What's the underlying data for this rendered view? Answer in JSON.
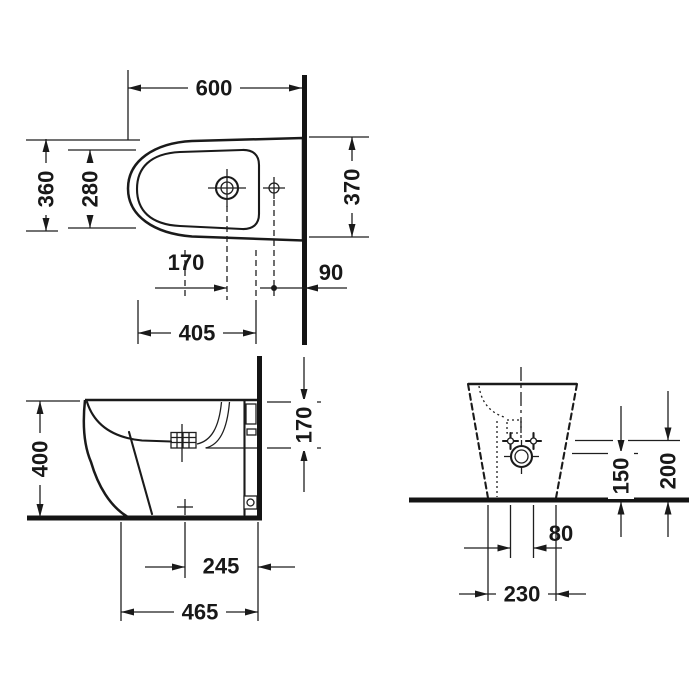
{
  "drawing": {
    "type": "bidet-installation-technical-drawing",
    "colors": {
      "line": "#1a1a1a",
      "background": "#ffffff"
    },
    "dimensions": {
      "plan": {
        "overall_depth": "600",
        "front_width": "360",
        "bowl_width": "280",
        "wall_width": "370",
        "tap_hole_offset": "170",
        "fixing_to_wall": "90",
        "front_to_fixing": "405"
      },
      "side": {
        "height": "400",
        "rim_to_inlet": "170",
        "wall_to_outlet": "245",
        "wall_to_base_front": "465"
      },
      "rear": {
        "outlet_height": "150",
        "fixing_height": "200",
        "fixing_spacing": "80",
        "base_width": "230"
      }
    }
  }
}
